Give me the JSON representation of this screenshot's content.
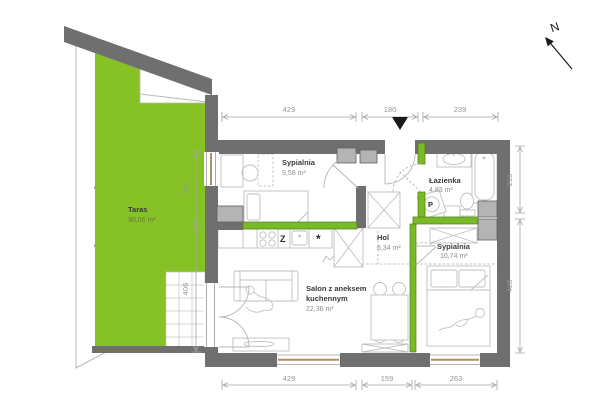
{
  "plan": {
    "compass": "N",
    "rooms": {
      "taras": {
        "name": "Taras",
        "area": "30,06 m²"
      },
      "bedroom1": {
        "name": "Sypialnia",
        "area": "9,58 m²"
      },
      "bathroom": {
        "name": "Łazienka",
        "area": "4,83 m²"
      },
      "hall": {
        "name": "Hol",
        "area": "6,34 m²"
      },
      "bedroom2": {
        "name": "Sypialnia",
        "area": "10,74 m²"
      },
      "living": {
        "line1": "Salon z aneksem",
        "line2": "kuchennym",
        "area": "22,36 m²"
      }
    },
    "symbols": {
      "dishwasher": "Z",
      "washing_machine": "P",
      "fridge": "*"
    },
    "dims": {
      "top": [
        "429",
        "180",
        "239"
      ],
      "bottom": [
        "429",
        "159",
        "263"
      ],
      "right": [
        "216",
        "428"
      ],
      "left": [
        "240",
        "406"
      ]
    },
    "colors": {
      "terrace": "#86c226",
      "wall": "#6f6f6f",
      "accent": "#79ba28"
    }
  }
}
